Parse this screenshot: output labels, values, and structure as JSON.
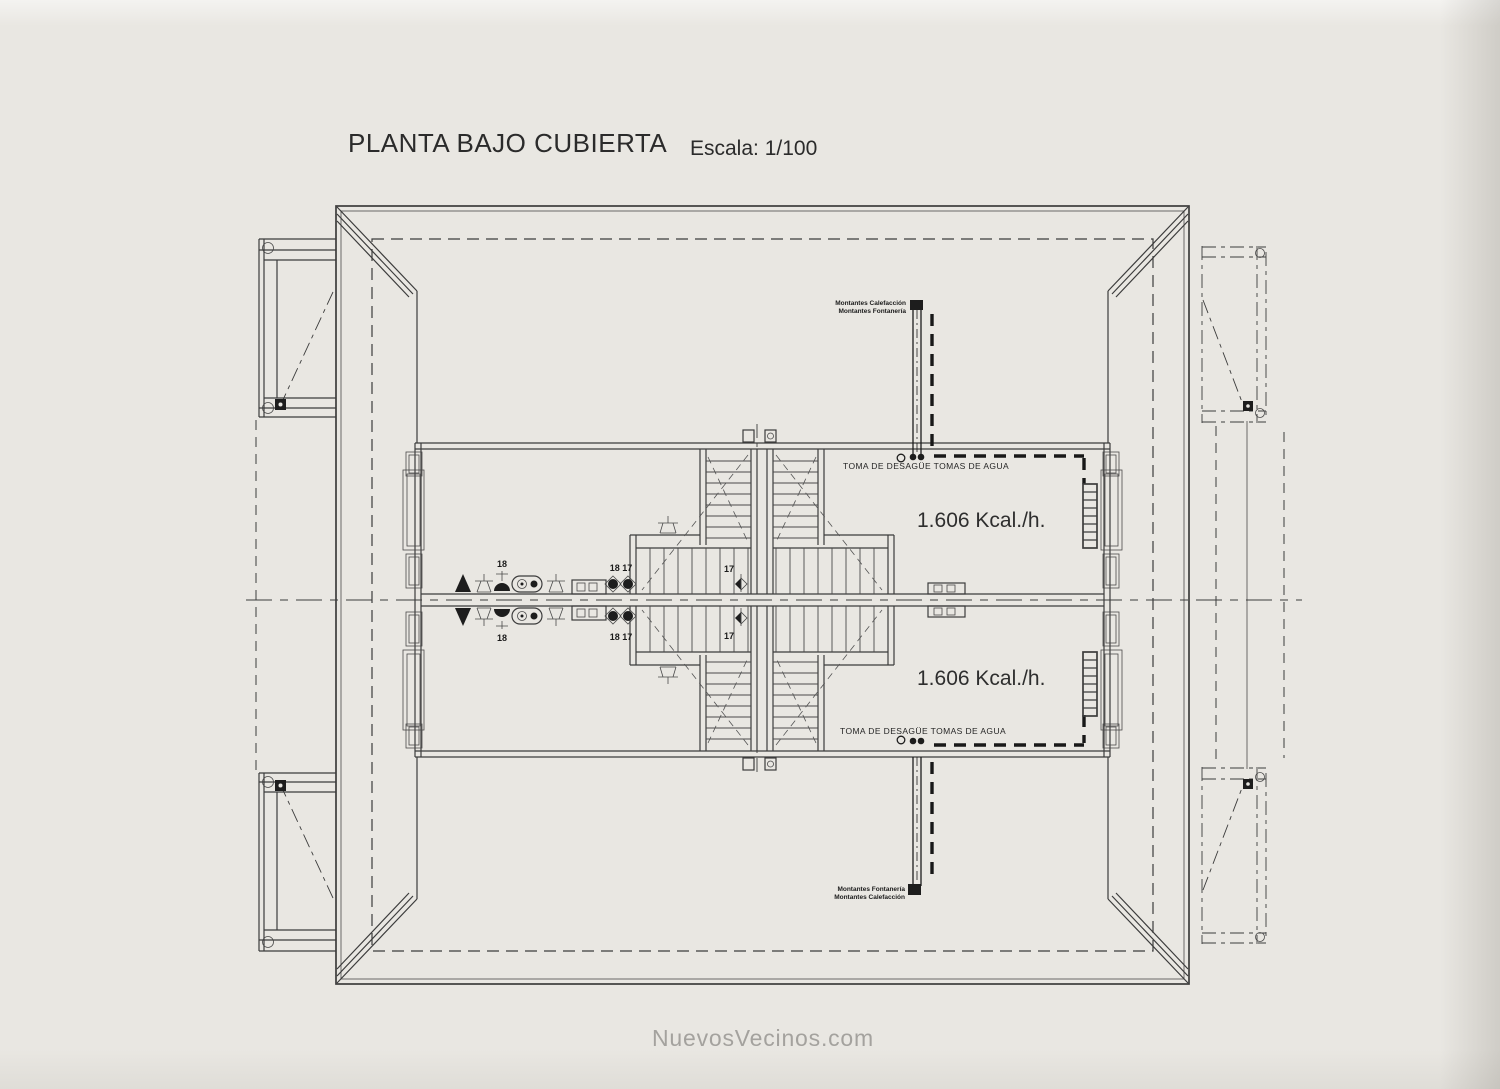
{
  "title": {
    "main": "PLANTA BAJO CUBIERTA",
    "scale": "Escala: 1/100"
  },
  "watermark": "NuevosVecinos.com",
  "units": {
    "top": {
      "heat": "1.606 Kcal./h.",
      "toma": "TOMA DE DESAGÜE TOMAS DE AGUA",
      "riser_line1": "Montantes Calefacción",
      "riser_line2": "Montantes Fontanería",
      "n18": "18",
      "n18_17": "18 17",
      "n17": "17"
    },
    "bottom": {
      "heat": "1.606 Kcal./h.",
      "toma": "TOMA DE DESAGÜE TOMAS DE AGUA",
      "riser_line1": "Montantes Fontanería",
      "riser_line2": "Montantes Calefacción",
      "n18": "18",
      "n18_17": "18 17",
      "n17": "17"
    }
  },
  "colors": {
    "paper": "#e9e7e2",
    "ink": "#3c3c3c",
    "watermark": "#a4a29e"
  }
}
